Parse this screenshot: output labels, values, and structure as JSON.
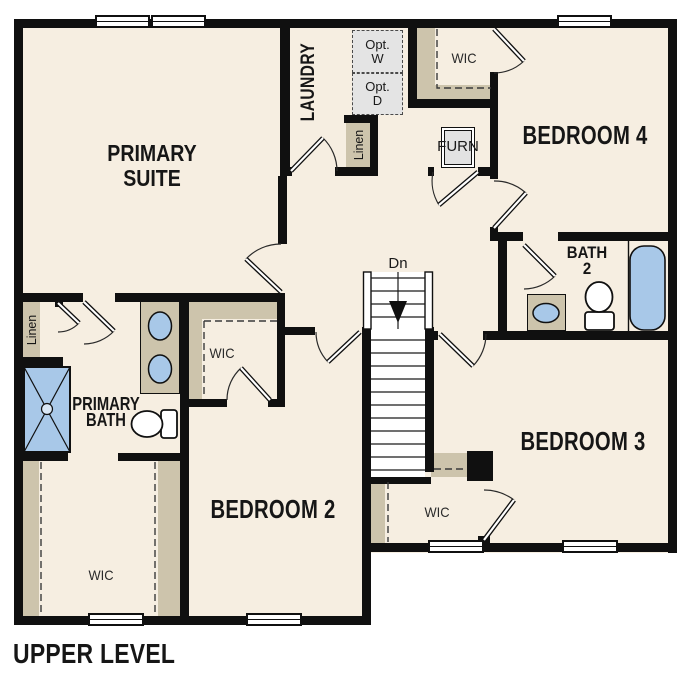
{
  "title": "UPPER LEVEL",
  "labels": {
    "primary_suite": "PRIMARY\nSUITE",
    "laundry": "LAUNDRY",
    "opt_washer": [
      "Opt.",
      "W"
    ],
    "opt_dryer": [
      "Opt.",
      "D"
    ],
    "wic_top": "WIC",
    "linen_top": "Linen",
    "furn": "FURN",
    "bedroom_4": "BEDROOM 4",
    "bath_2": [
      "BATH",
      "2"
    ],
    "stairs_direction": "Dn",
    "bedroom_3": "BEDROOM 3",
    "wic_mid": "WIC",
    "linen_left": "Linen",
    "primary_bath": [
      "PRIMARY",
      "BATH"
    ],
    "wic_bottom_left": "WIC",
    "bedroom_2": "BEDROOM 2",
    "wic_bottom_mid": "WIC"
  },
  "colors": {
    "floor": "#f6eee1",
    "wall": "#101010",
    "shelving": "#cdc4ac",
    "fixture_blue": "#a8c8e8",
    "equipment_gray": "#e4e4e4"
  }
}
